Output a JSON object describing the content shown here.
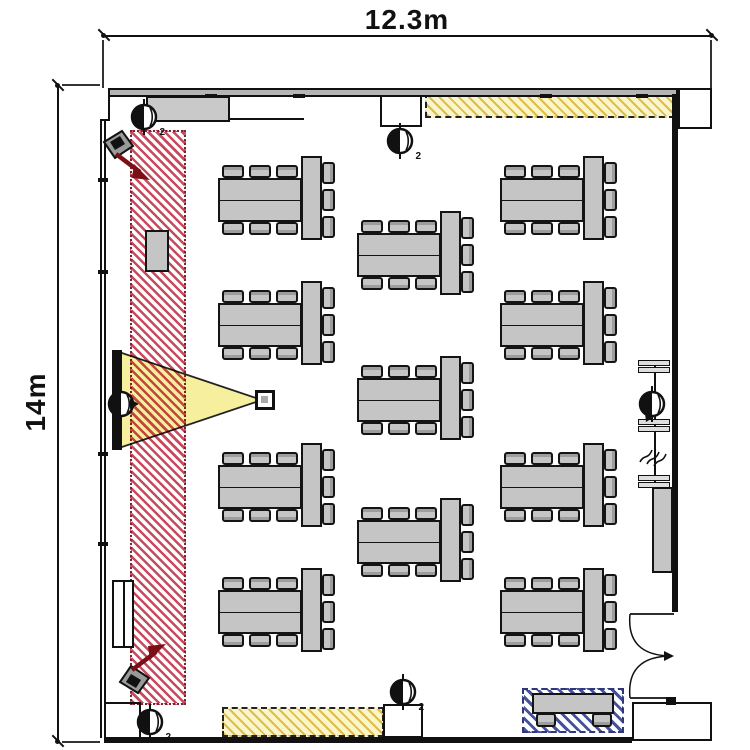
{
  "diagram": {
    "type": "room-floor-plan",
    "dimensions": {
      "width_label": "12.3m",
      "height_label": "14m"
    },
    "labels": {
      "sound_desk": "音響卓"
    },
    "colors": {
      "red_hatch": "#c84a5e",
      "yellow_zone_bg": "#fbf6ca",
      "yellow_zone_stripe": "#dbb234",
      "beam_yellow": "#f6f09e",
      "blue_hatch": "#45519a",
      "table_gray": "#c5c5c5",
      "wall_gray": "#b5b5b5",
      "arrow_red": "#7a1016"
    },
    "zones": [
      {
        "name": "stage-red-hatch-strip",
        "style": "red-diagonal-hatch"
      },
      {
        "name": "top-storage-strip",
        "style": "yellow-diagonal-hatch"
      },
      {
        "name": "bottom-storage-strip",
        "style": "yellow-diagonal-hatch"
      },
      {
        "name": "reception-blue-hatch",
        "style": "blue-diagonal-hatch"
      },
      {
        "name": "projection-beam",
        "style": "yellow-triangle"
      }
    ]
  },
  "furniture": {
    "table_groups": [
      {
        "x": 218,
        "y": 178
      },
      {
        "x": 218,
        "y": 303
      },
      {
        "x": 218,
        "y": 465
      },
      {
        "x": 218,
        "y": 590
      },
      {
        "x": 357,
        "y": 233
      },
      {
        "x": 357,
        "y": 378
      },
      {
        "x": 357,
        "y": 520
      },
      {
        "x": 500,
        "y": 178
      },
      {
        "x": 500,
        "y": 303
      },
      {
        "x": 500,
        "y": 465
      },
      {
        "x": 500,
        "y": 590
      }
    ],
    "chairs_per_group": 9,
    "podium": {
      "x": 145,
      "y": 230,
      "w": 24,
      "h": 42
    },
    "reception_table": {
      "x": 532,
      "y": 693,
      "w": 82,
      "h": 21,
      "chairs": 2
    },
    "side_board": {
      "x": 652,
      "y": 487,
      "w": 21,
      "h": 86
    },
    "radiator": {
      "x": 112,
      "y": 580,
      "w": 22,
      "h": 68
    }
  },
  "equipment": {
    "screen": {
      "x": 112,
      "y": 350,
      "w": 10,
      "h": 100
    },
    "projector": {
      "x": 255,
      "y": 390,
      "w": 20,
      "h": 20
    },
    "ceiling_fixtures": [
      {
        "x": 144,
        "y": 117,
        "sub": "2",
        "cone": "none"
      },
      {
        "x": 400,
        "y": 141,
        "sub": "2",
        "cone": "none"
      },
      {
        "x": 121,
        "y": 404,
        "sub": "",
        "cone": "right"
      },
      {
        "x": 652,
        "y": 404,
        "sub": "",
        "cone": "down"
      },
      {
        "x": 403,
        "y": 692,
        "sub": "2",
        "cone": "none"
      },
      {
        "x": 150,
        "y": 722,
        "sub": "2",
        "cone": "none"
      }
    ],
    "speakers": [
      {
        "x": 96,
        "y": 126,
        "dir": "down"
      },
      {
        "x": 112,
        "y": 634,
        "dir": "up"
      }
    ]
  }
}
